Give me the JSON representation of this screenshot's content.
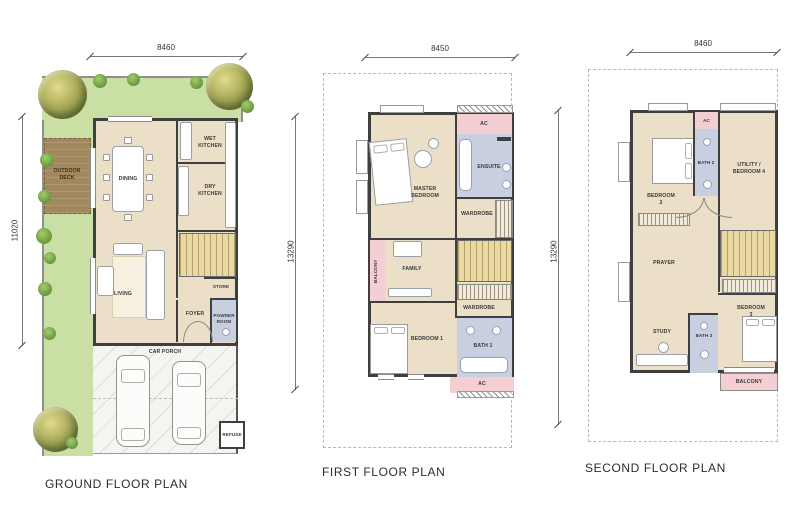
{
  "colors": {
    "wall": "#3f3f3f",
    "interior": "#ecdfc8",
    "garden": "#c9dfa4",
    "deck": "#a1885e",
    "stairs": "#ead9a2",
    "pink": "#f4ced2",
    "bath": "#c7cfe1",
    "porch": "#f4f4f1",
    "lot": "#b8b8b8",
    "label": "#3a3a3a"
  },
  "ground": {
    "title": "GROUND FLOOR PLAN",
    "dim_width": "8460",
    "dim_height": "11020",
    "rooms": {
      "outdoor_deck": "OUTDOOR DECK",
      "dining": "DINING",
      "wet_kitchen": "WET KITCHEN",
      "dry_kitchen": "DRY KITCHEN",
      "living": "LIVING",
      "store": "STORE",
      "foyer": "FOYER",
      "powder_room": "POWDER ROOM",
      "car_porch": "CAR PORCH",
      "refuse": "REFUSE"
    }
  },
  "first": {
    "title": "FIRST FLOOR PLAN",
    "dim_width": "8450",
    "dim_height": "13290",
    "rooms": {
      "ac_top": "AC",
      "master_bedroom": "MASTER BEDROOM",
      "ensuite": "ENSUITE",
      "wardrobe_master": "WARDROBE",
      "balcony": "BALCONY",
      "family": "FAMILY",
      "wardrobe_1": "WARDROBE",
      "bedroom_1": "BEDROOM 1",
      "bath_1": "BATH 1",
      "ac_bottom": "AC"
    }
  },
  "second": {
    "title": "SECOND FLOOR PLAN",
    "dim_width": "8460",
    "dim_height": "13290",
    "rooms": {
      "ac": "AC",
      "bedroom_2": "BEDROOM 2",
      "bath_2": "BATH 2",
      "utility_bedroom_4": "UTILITY / BEDROOM 4",
      "prayer": "PRAYER",
      "bedroom_3": "BEDROOM 3",
      "study": "STUDY",
      "bath_3": "BATH 3",
      "balcony": "BALCONY"
    }
  }
}
